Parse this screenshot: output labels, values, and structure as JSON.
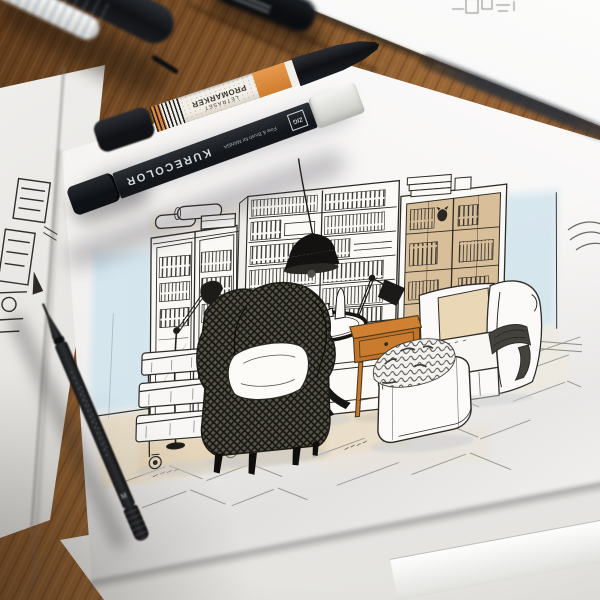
{
  "scene": {
    "description": "Ink and marker interior sketch (living room with bookcases, wingback chair, sofa) on white paper, with art markers and a fineliner pen on a wooden desk"
  },
  "markers": {
    "kurecolor": {
      "brand": "KURECOLOR",
      "subtitle": "Fine & Brush for MANGA",
      "logo": "ZIG",
      "body_color": "#1c2126",
      "cap_color": "#e9e9e6"
    },
    "promarker": {
      "brand": "LETRASET",
      "model": "PROMARKER",
      "accent_color": "#dd8a3e"
    },
    "fineliner": {
      "mark": "M",
      "body_color": "#1e2023"
    }
  },
  "colors": {
    "wood": "#7d5128",
    "paper": "#f6f5f3",
    "wall_wash_blue": "#cfe3ec",
    "floor_wash_tan": "#ead9bb",
    "furniture_accent_orange": "#c8772b",
    "ink": "#24231f"
  }
}
